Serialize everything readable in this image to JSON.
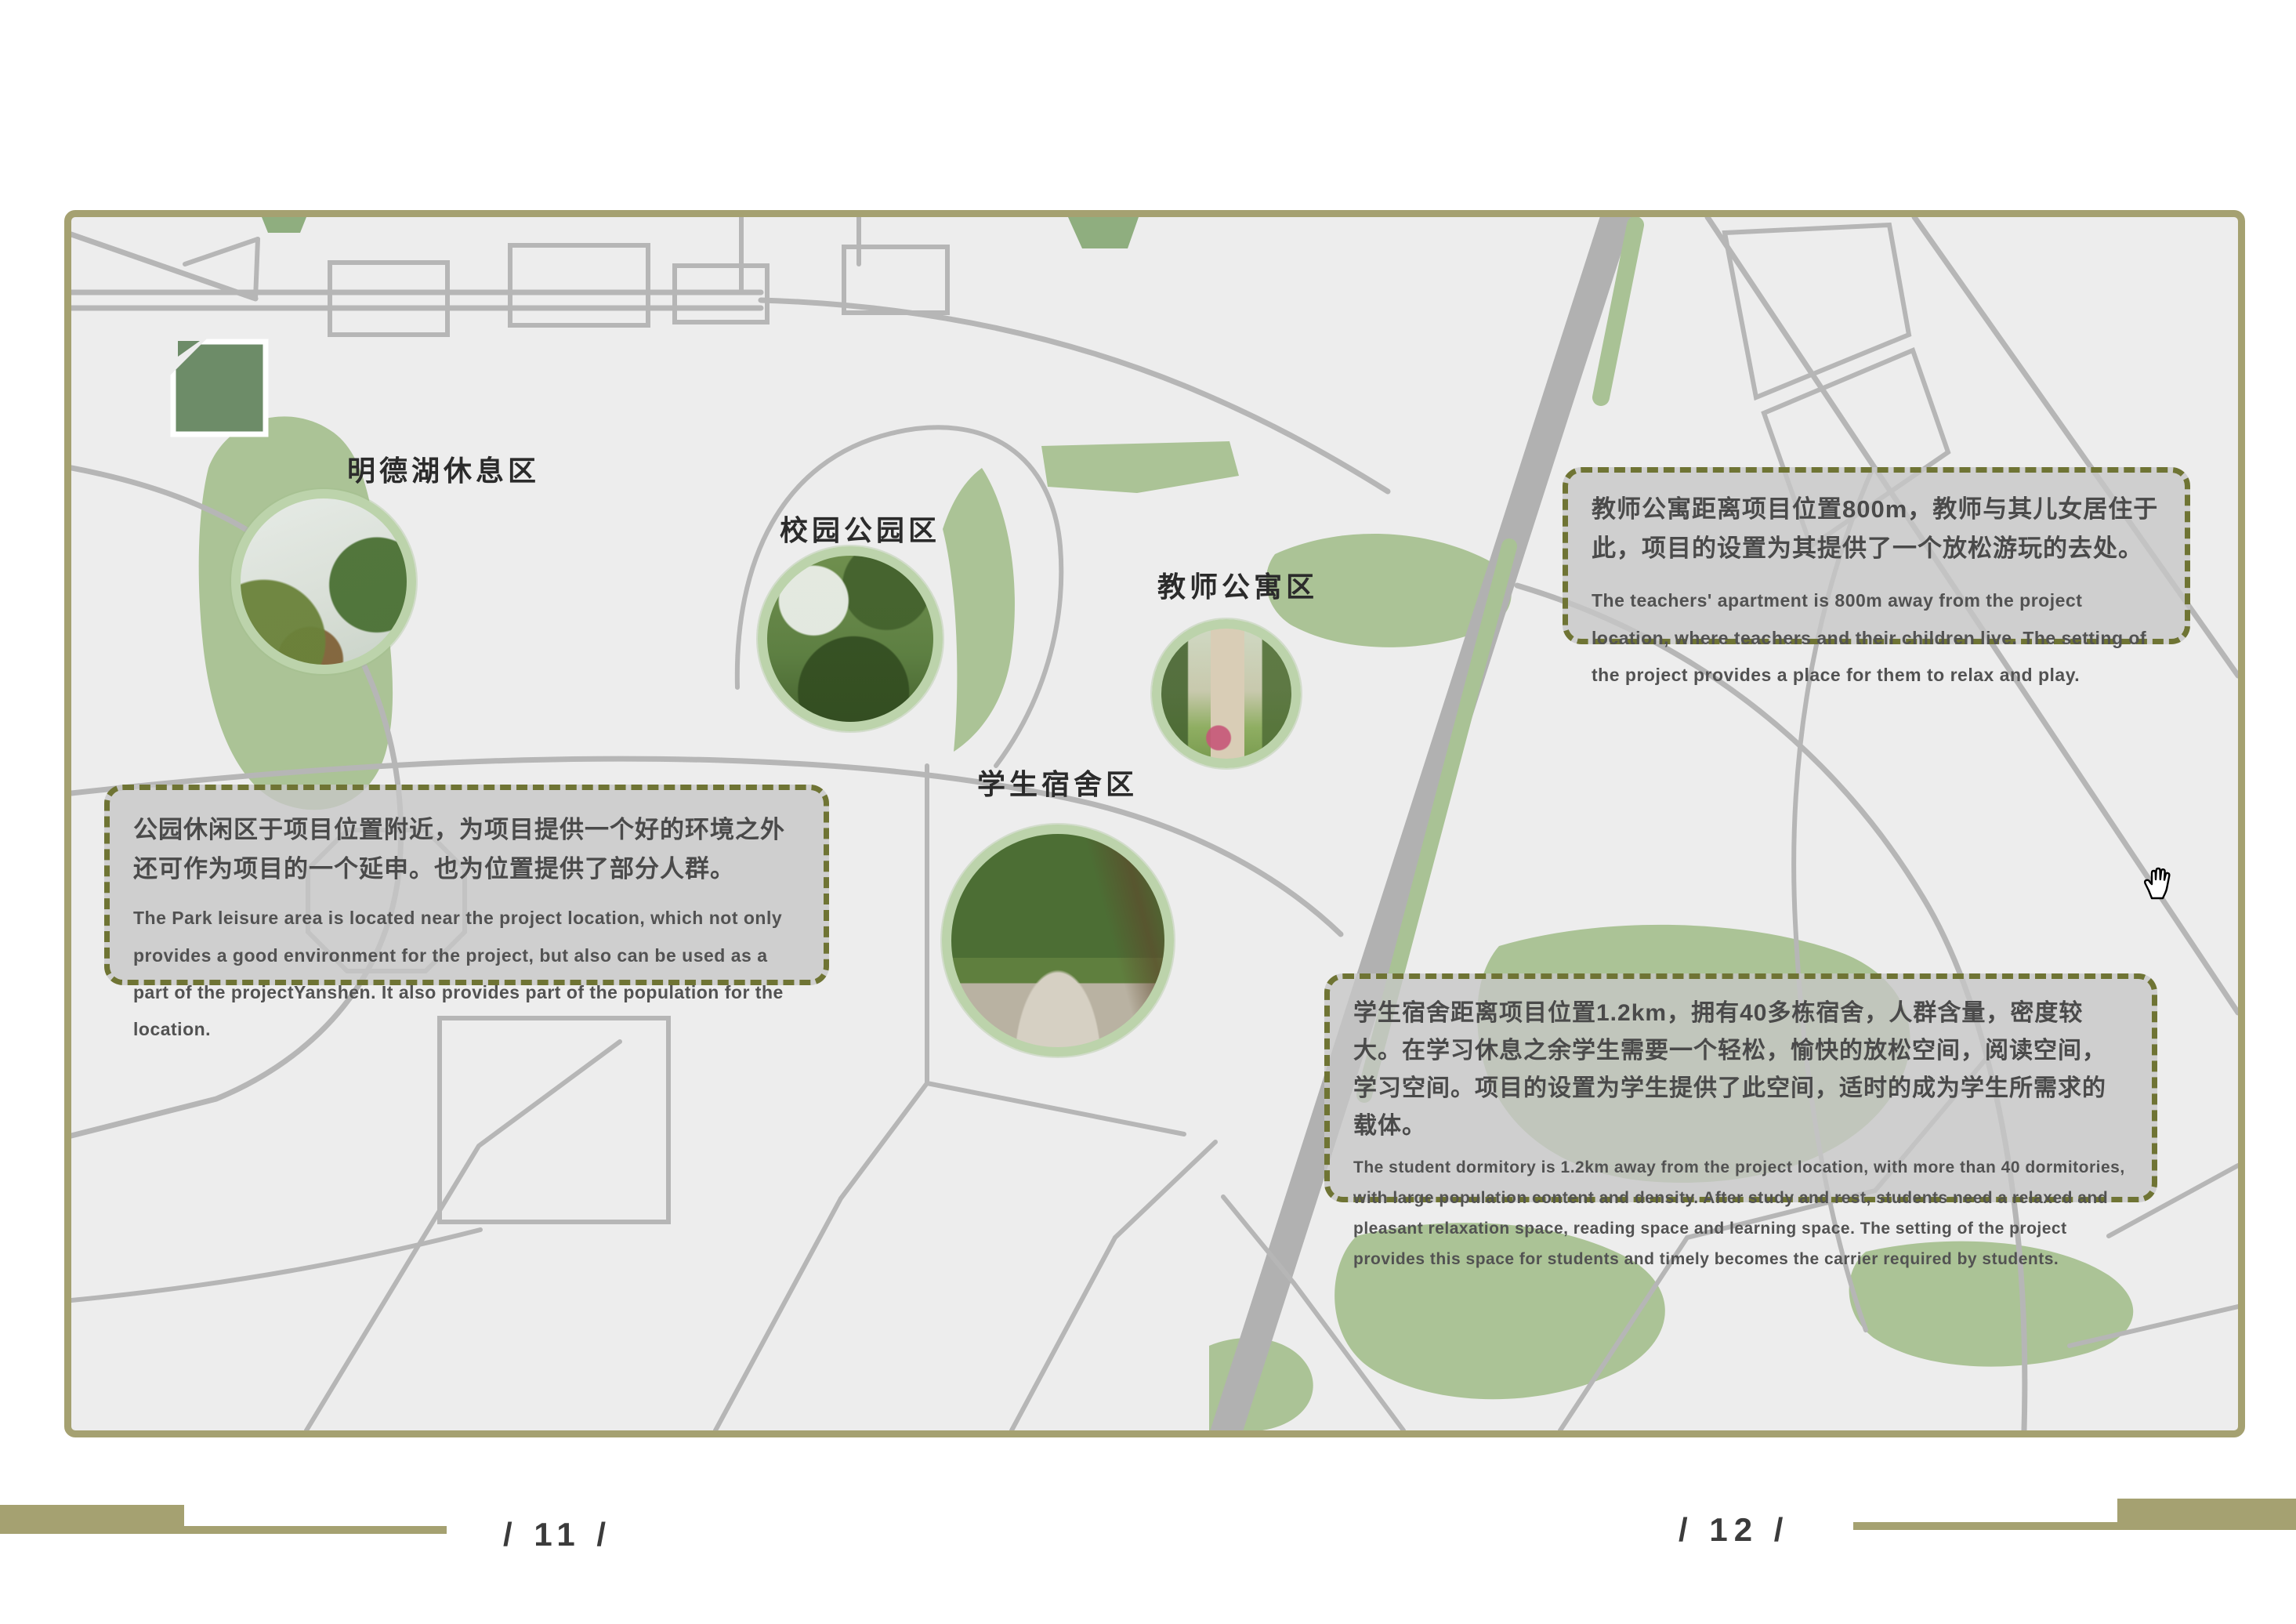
{
  "page": {
    "type": "site-analysis-map-spread"
  },
  "map": {
    "labels": [
      {
        "id": "lake",
        "text": "明德湖休息区"
      },
      {
        "id": "park",
        "text": "校园公园区"
      },
      {
        "id": "apartment",
        "text": "教师公寓区"
      },
      {
        "id": "dormitory",
        "text": "学生宿舍区"
      }
    ],
    "photos": [
      {
        "id": "lake",
        "desc": "lake with tree-lined banks"
      },
      {
        "id": "park",
        "desc": "campus park pond with bridge and trees"
      },
      {
        "id": "apartment",
        "desc": "apartment building with trees, lawn and flowers"
      },
      {
        "id": "dormitory",
        "desc": "tree-covered path with parked bicycles"
      }
    ]
  },
  "callouts": {
    "park": {
      "zh": "公园休闲区于项目位置附近，为项目提供一个好的环境之外还可作为项目的一个延申。也为位置提供了部分人群。",
      "en": "The Park leisure area is located near the project location, which not only provides a good environment for the project, but also can be used as a part of the projectYanshen. It also provides part of the population for the location."
    },
    "teachers": {
      "zh": "教师公寓距离项目位置800m，教师与其儿女居住于此，项目的设置为其提供了一个放松游玩的去处。",
      "en": "The teachers' apartment is 800m away from the project location, where teachers and their children live. The setting of the project provides a place for them to relax and play."
    },
    "students": {
      "zh": "学生宿舍距离项目位置1.2km，拥有40多栋宿舍，人群含量，密度较大。在学习休息之余学生需要一个轻松，愉快的放松空间，阅读空间，学习空间。项目的设置为学生提供了此空间，适时的成为学生所需求的载体。",
      "en": "The student dormitory is 1.2km away from the project location, with more than 40 dormitories, with large population content and density. After study and rest, students need a relaxed and pleasant relaxation space, reading space and learning space. The setting of the project provides this space for students and timely becomes the carrier required by students."
    }
  },
  "footer": {
    "left_page": "/ 11 /",
    "right_page": "/ 12 /"
  },
  "cursor": {
    "icon": "grab-hand"
  },
  "colors": {
    "frame_khaki": "#a5a171",
    "dash_olive": "#6f7434",
    "callout_bg": "#c6c6c6",
    "map_bg": "#ededed",
    "road_gray": "#b6b6b6",
    "highway_gray": "#b1b1b1",
    "green_patch": "#abc396",
    "dark_green_building": "#6d8c68",
    "circle_ring": "#bcd3ab",
    "text_dark": "#4a4a4a"
  }
}
